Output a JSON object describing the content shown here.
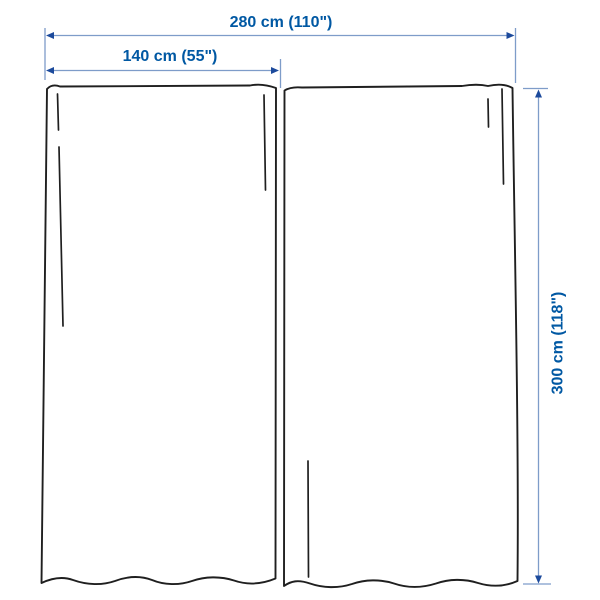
{
  "diagram": {
    "labels": {
      "width_total": "280 cm (110\")",
      "width_panel": "140 cm (55\")",
      "height": "300 cm (118\")"
    },
    "values": {
      "width_total_cm": 280,
      "width_total_inches": 110,
      "panel_width_cm": 140,
      "panel_width_inches": 55,
      "height_cm": 300,
      "height_inches": 118
    },
    "colors": {
      "label_text": "#0058a3",
      "dimension_line": "#7e9cc9",
      "arrowhead": "#1c4a9c",
      "curtain_outline": "#1f1f1f",
      "background": "#ffffff"
    },
    "icons": {
      "left": "arrow-left-icon",
      "right": "arrow-right-icon",
      "up": "arrow-up-icon",
      "down": "arrow-down-icon"
    }
  }
}
